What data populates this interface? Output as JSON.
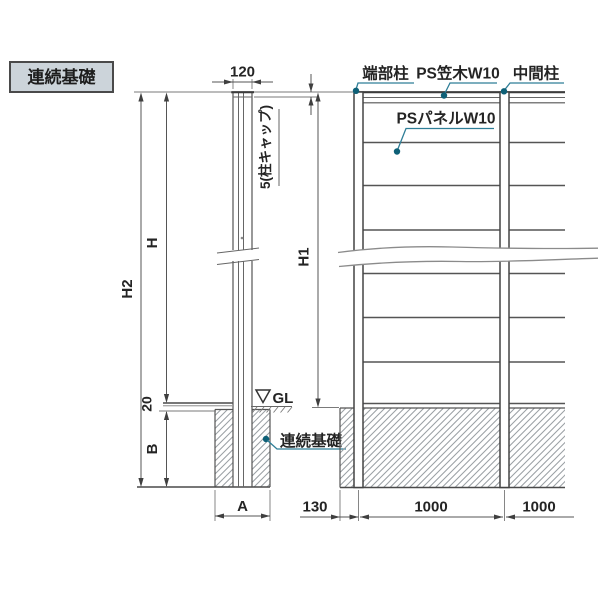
{
  "title": "連続基礎",
  "side_view": {
    "dims": {
      "width": "120",
      "cap": "5(柱キャップ)",
      "h2": "H2",
      "h": "H",
      "gl_offset": "20",
      "depth": "B",
      "foundation_width": "A"
    },
    "gl": "GL",
    "foundation_label": "連続基礎"
  },
  "elevation": {
    "labels": {
      "end_post": "端部柱",
      "coping": "PS笠木W10",
      "mid_post": "中間柱",
      "panel": "PSパネルW10"
    },
    "dims": {
      "h1": "H1",
      "edge": "130",
      "span1": "1000",
      "span2": "1000"
    }
  },
  "colors": {
    "leader": "#2e7e97",
    "leader_dot": "#0e6077",
    "title_bg": "#ccd4da",
    "line": "#4a4a4a"
  }
}
